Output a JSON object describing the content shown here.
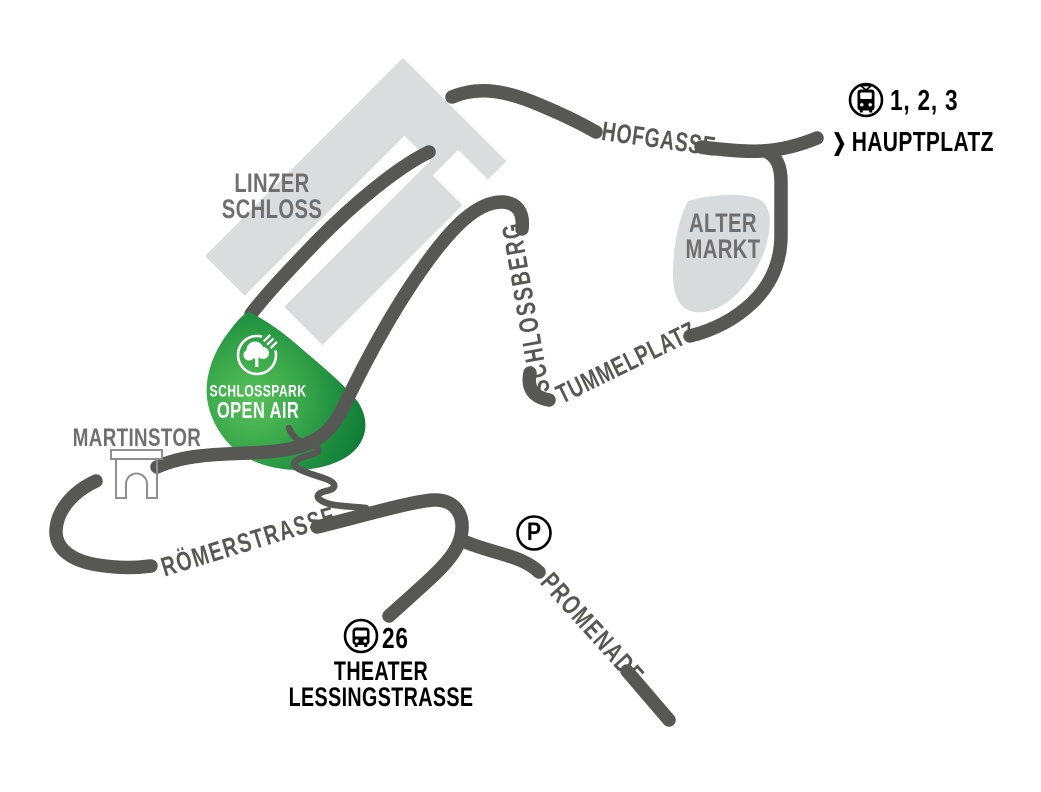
{
  "map": {
    "streets": {
      "hofgasse": "HOFGASSE",
      "schlossberg": "SCHLOSSBERG",
      "tummelplatz": "TUMMELPLATZ",
      "roemerstrasse": "RÖMERSTRASSE",
      "promenade": "PROMENADE"
    },
    "places": {
      "linzer_schloss_line1": "LINZER",
      "linzer_schloss_line2": "SCHLOSS",
      "alter_markt_line1": "ALTER",
      "alter_markt_line2": "MARKT",
      "martinstor": "MARTINSTOR"
    },
    "venue": {
      "line1": "SCHLOSSPARK",
      "line2": "OPEN AIR"
    },
    "transit": {
      "tram_lines": "1, 2, 3",
      "tram_destination": "HAUPTPLATZ",
      "chevron": "❯",
      "bus_line": "26",
      "bus_stop_line1": "THEATER",
      "bus_stop_line2": "LESSINGSTRASSE",
      "parking": "P"
    },
    "colors": {
      "road": "#575756",
      "building": "#dbdcdd",
      "park_green_center": "#58bf5a",
      "park_green_edge": "#0f7a37",
      "place_label": "#6f6f70",
      "street_label": "#575756",
      "black_text": "#000000"
    }
  }
}
